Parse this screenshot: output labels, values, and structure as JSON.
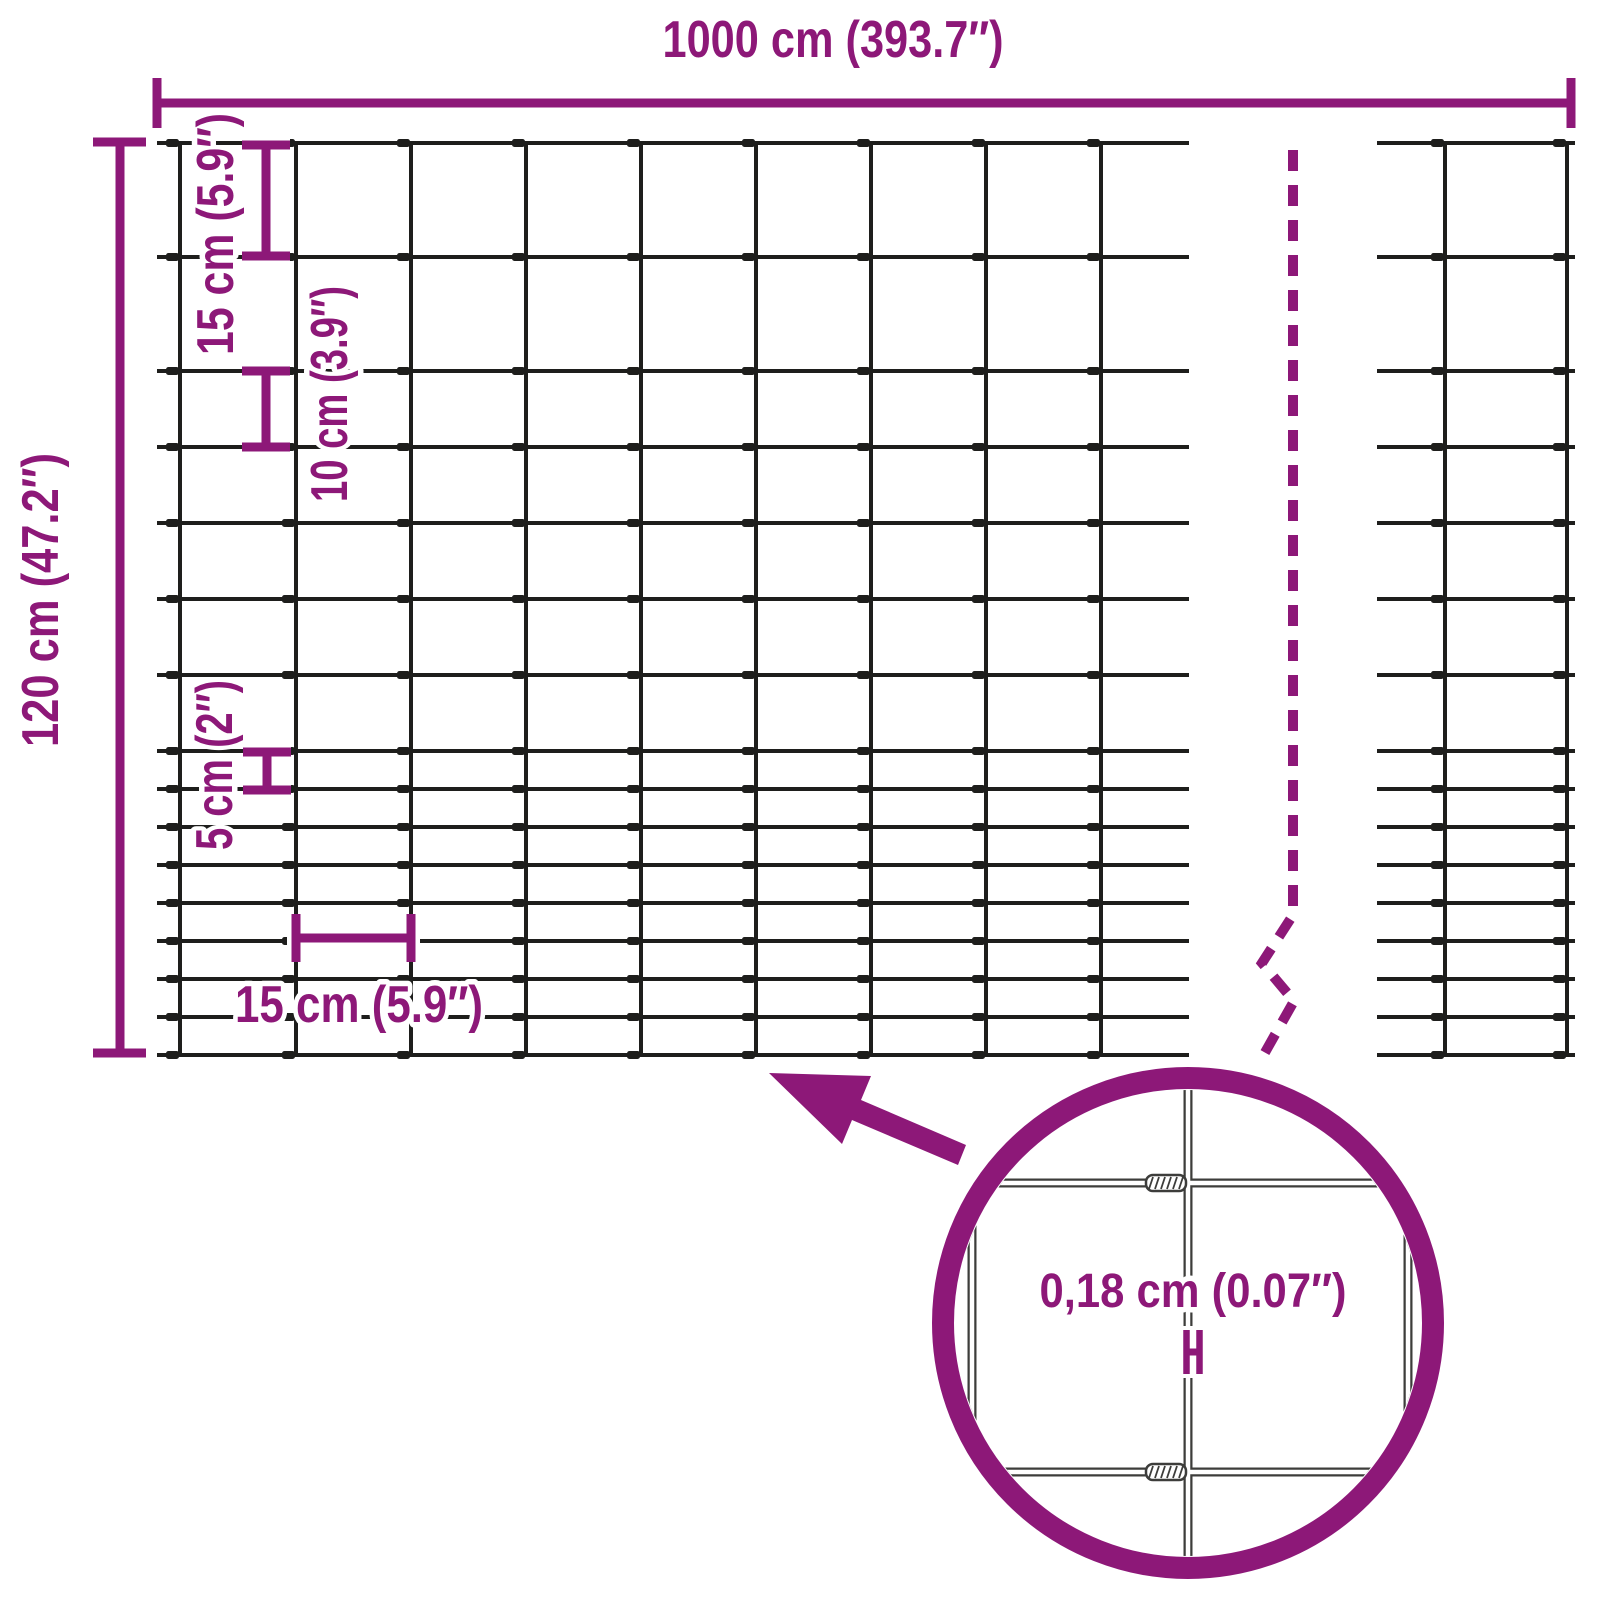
{
  "figure": {
    "type": "product-dimension-diagram",
    "subject": "wire mesh fence"
  },
  "colors": {
    "accent": "#8D1878",
    "wire": "#1E1E1C",
    "background": "#FFFFFF"
  },
  "labels": {
    "total_length": "1000 cm (393.7″)",
    "total_height": "120 cm (47.2″)",
    "row_gap_top": "15 cm (5.9″)",
    "row_gap_middle": "10 cm (3.9″)",
    "row_gap_bottom": "5 cm (2″)",
    "column_gap": "15 cm (5.9″)",
    "wire_thickness": "0,18 cm (0.07″)"
  },
  "mesh": {
    "length_cm": 1000,
    "height_cm": 120,
    "column_spacing_cm": 15,
    "wire_diameter_cm": "0,18",
    "row_gaps_cm_top_to_bottom": [
      15,
      15,
      10,
      10,
      10,
      10,
      10,
      5,
      5,
      5,
      5,
      5,
      5,
      5,
      5
    ]
  }
}
